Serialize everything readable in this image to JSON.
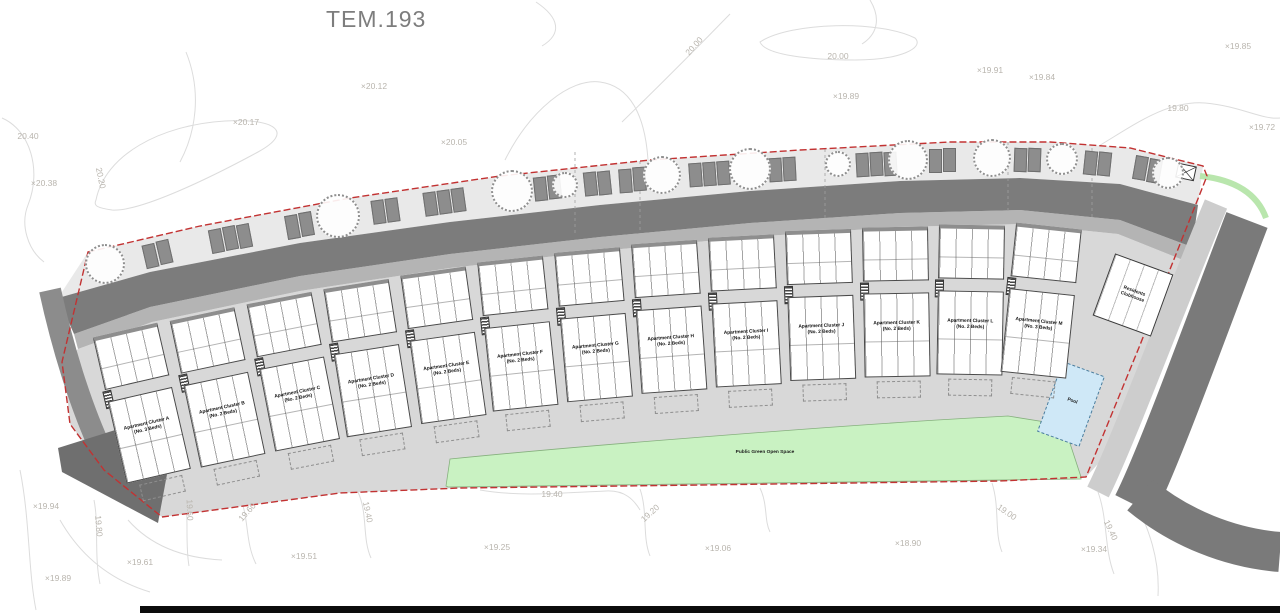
{
  "title": "TEM.193",
  "site": {
    "green_space_label": "Public Green Open Space",
    "pool_label": "Pool",
    "clubhouse_label_line1": "Residents",
    "clubhouse_label_line2": "Clubhouse"
  },
  "clusters": [
    {
      "id": "A",
      "name": "Apartment Cluster A",
      "beds": "(No. 3 Beds)"
    },
    {
      "id": "B",
      "name": "Apartment Cluster B",
      "beds": "(No. 2 Beds)"
    },
    {
      "id": "C",
      "name": "Apartment Cluster C",
      "beds": "(No. 2 Beds)"
    },
    {
      "id": "D",
      "name": "Apartment Cluster D",
      "beds": "(No. 2 Beds)"
    },
    {
      "id": "E",
      "name": "Apartment Cluster E",
      "beds": "(No. 2 Beds)"
    },
    {
      "id": "F",
      "name": "Apartment Cluster F",
      "beds": "(No. 2 Beds)"
    },
    {
      "id": "G",
      "name": "Apartment Cluster G",
      "beds": "(No. 2 Beds)"
    },
    {
      "id": "H",
      "name": "Apartment Cluster H",
      "beds": "(No. 2 Beds)"
    },
    {
      "id": "I",
      "name": "Apartment Cluster I",
      "beds": "(No. 2 Beds)"
    },
    {
      "id": "J",
      "name": "Apartment Cluster J",
      "beds": "(No. 2 Beds)"
    },
    {
      "id": "K",
      "name": "Apartment Cluster K",
      "beds": "(No. 2 Beds)"
    },
    {
      "id": "L",
      "name": "Apartment Cluster L",
      "beds": "(No. 2 Beds)"
    },
    {
      "id": "M",
      "name": "Apartment Cluster M",
      "beds": "(No. 3 Beds)"
    }
  ],
  "elevation_markers": [
    {
      "text": "20.40",
      "x": 28,
      "y": 136
    },
    {
      "text": "×20.38",
      "x": 44,
      "y": 183
    },
    {
      "text": "20.20",
      "x": 101,
      "y": 178,
      "rot": 78
    },
    {
      "text": "×20.17",
      "x": 246,
      "y": 122
    },
    {
      "text": "×20.12",
      "x": 374,
      "y": 86
    },
    {
      "text": "×20.05",
      "x": 454,
      "y": 142
    },
    {
      "text": "20.00",
      "x": 694,
      "y": 46,
      "rot": -48
    },
    {
      "text": "20.00",
      "x": 838,
      "y": 56
    },
    {
      "text": "×19.89",
      "x": 846,
      "y": 96
    },
    {
      "text": "×19.91",
      "x": 990,
      "y": 70
    },
    {
      "text": "×19.84",
      "x": 1042,
      "y": 77
    },
    {
      "text": "×19.85",
      "x": 1238,
      "y": 46
    },
    {
      "text": "19.80",
      "x": 1178,
      "y": 108
    },
    {
      "text": "×19.72",
      "x": 1262,
      "y": 127
    },
    {
      "text": "×19.94",
      "x": 46,
      "y": 506
    },
    {
      "text": "19.80",
      "x": 99,
      "y": 526,
      "rot": 85
    },
    {
      "text": "×19.89",
      "x": 58,
      "y": 578
    },
    {
      "text": "×19.61",
      "x": 140,
      "y": 562
    },
    {
      "text": "19.60",
      "x": 190,
      "y": 510,
      "rot": 88
    },
    {
      "text": "19.60",
      "x": 247,
      "y": 512,
      "rot": -48
    },
    {
      "text": "×19.51",
      "x": 304,
      "y": 556
    },
    {
      "text": "19.40",
      "x": 368,
      "y": 512,
      "rot": 78
    },
    {
      "text": "19.40",
      "x": 552,
      "y": 494
    },
    {
      "text": "×19.25",
      "x": 497,
      "y": 547
    },
    {
      "text": "19.20",
      "x": 650,
      "y": 513,
      "rot": -42
    },
    {
      "text": "×19.06",
      "x": 718,
      "y": 548
    },
    {
      "text": "×18.90",
      "x": 908,
      "y": 543
    },
    {
      "text": "19.00",
      "x": 1007,
      "y": 512,
      "rot": 35
    },
    {
      "text": "×19.34",
      "x": 1094,
      "y": 549
    },
    {
      "text": "19.40",
      "x": 1111,
      "y": 530,
      "rot": 65
    }
  ],
  "colors": {
    "boundary_red": "#c23232",
    "road_dark": "#7c7c7c",
    "road_corner": "#6f6f6f",
    "footpath": "#b4b4b4",
    "hardstanding": "#d8d8d8",
    "verge": "#e9e9e9",
    "green_open_space": "#c9f2c2",
    "pool_blue": "#cfe8f7",
    "building_white": "#ffffff",
    "contour_gray": "#dcdcdc",
    "marker_text": "#b9b5ae"
  }
}
